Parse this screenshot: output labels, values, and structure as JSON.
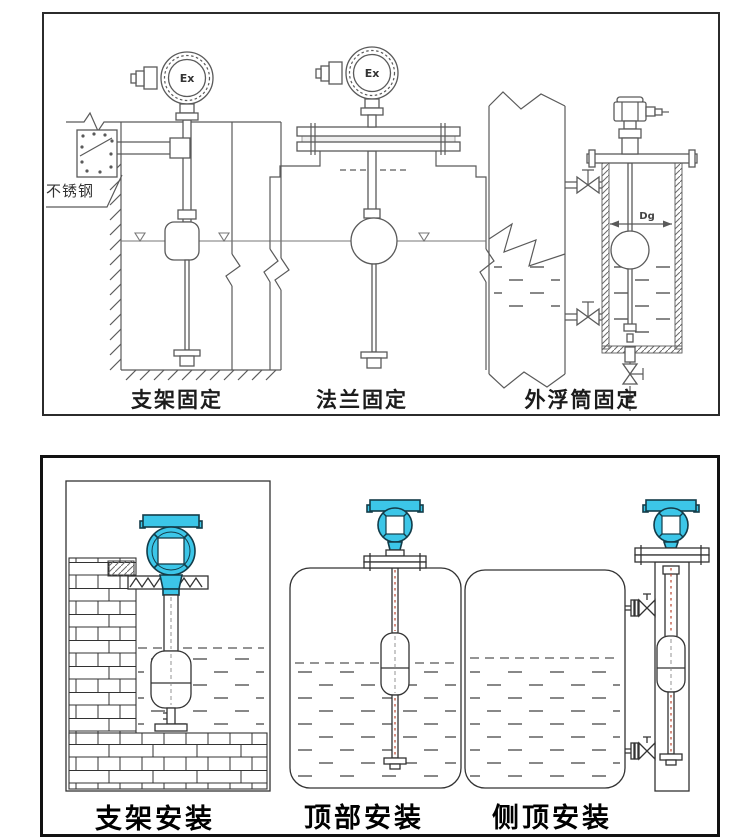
{
  "page": {
    "background": "#ffffff"
  },
  "colors": {
    "accent_cyan": "#3cc6e8",
    "line_gray": "#5a5a5a",
    "line_dark": "#333333",
    "cable_red": "#c0513d",
    "panel_border": "#111111"
  },
  "top_panel": {
    "labels": {
      "stainless_steel": "不锈钢",
      "ex_left": "Ex",
      "ex_middle": "Ex",
      "dg": "Dg"
    },
    "captions": [
      {
        "text": "支架固定"
      },
      {
        "text": "法兰固定"
      },
      {
        "text": "外浮筒固定"
      }
    ]
  },
  "bottom_panel": {
    "captions": [
      {
        "text": "支架安装"
      },
      {
        "text": "顶部安装"
      },
      {
        "text": "侧顶安装"
      }
    ]
  }
}
